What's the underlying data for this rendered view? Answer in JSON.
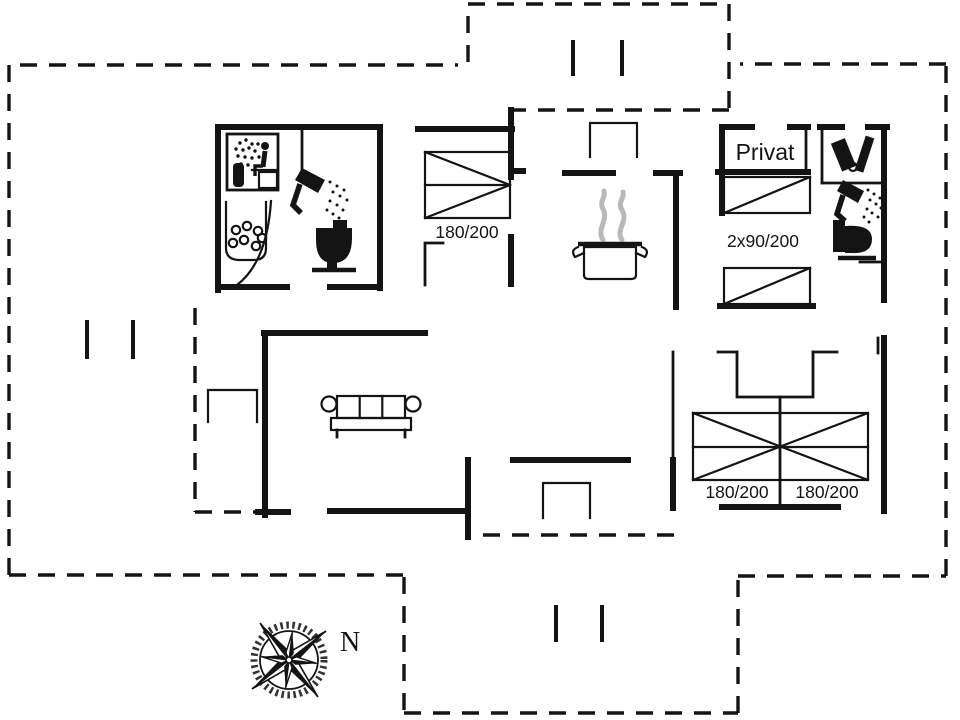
{
  "plan": {
    "type": "holiday-house-floor-plan",
    "colors": {
      "background": "#ffffff",
      "line": "#141414",
      "steam": "#b9b9b9"
    },
    "labels": {
      "privat": "Privat",
      "bedroom_left_bed": "180/200",
      "twin_beds": "2x90/200",
      "bedroom_right_bed_left": "180/200",
      "bedroom_right_bed_right": "180/200",
      "north": "N"
    },
    "rooms": [
      {
        "name": "bathroom-with-sauna",
        "icons": [
          "sauna-icon",
          "whirlpool-icon",
          "shower-icon",
          "toilet-icon"
        ]
      },
      {
        "name": "bedroom-left",
        "bed_size": "180/200"
      },
      {
        "name": "kitchen",
        "icons": [
          "cooking-pot-icon",
          "steam-icon"
        ]
      },
      {
        "name": "room-privat",
        "label": "Privat",
        "bed_size": "2x90/200"
      },
      {
        "name": "bathroom-right",
        "icons": [
          "sink-icon",
          "shower-icon",
          "toilet-icon"
        ]
      },
      {
        "name": "living-room",
        "icons": [
          "sofa-icon"
        ]
      },
      {
        "name": "bedroom-right",
        "bed_sizes": [
          "180/200",
          "180/200"
        ]
      }
    ],
    "compass": {
      "label": "N",
      "icon": "compass-rose-icon"
    }
  }
}
